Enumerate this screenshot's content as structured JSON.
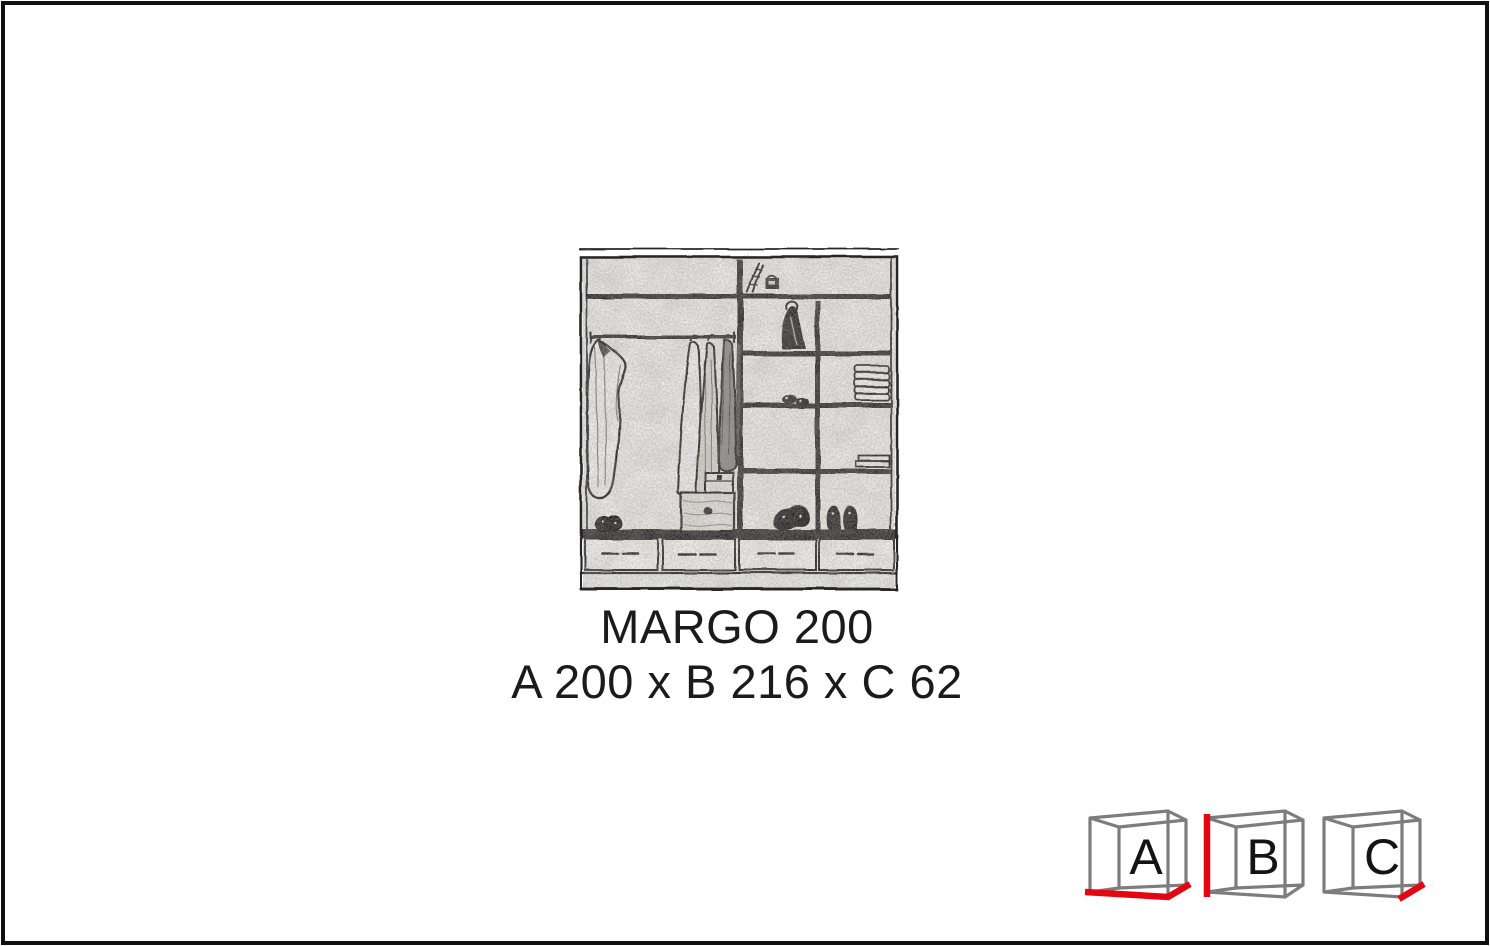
{
  "page": {
    "background": "#ffffff",
    "border_color": "#101010"
  },
  "product": {
    "name": "MARGO 200",
    "dimensions_line": "A 200 x B 216 x C 62",
    "dim_a_label": "A",
    "dim_a_value": "200",
    "dim_b_label": "B",
    "dim_b_value": "216",
    "dim_c_label": "C",
    "dim_c_value": "62"
  },
  "legend": {
    "accent_color": "#e30613",
    "wireframe_color": "#7d7d7d",
    "cubes": [
      {
        "label": "A"
      },
      {
        "label": "B"
      },
      {
        "label": "C"
      }
    ]
  }
}
